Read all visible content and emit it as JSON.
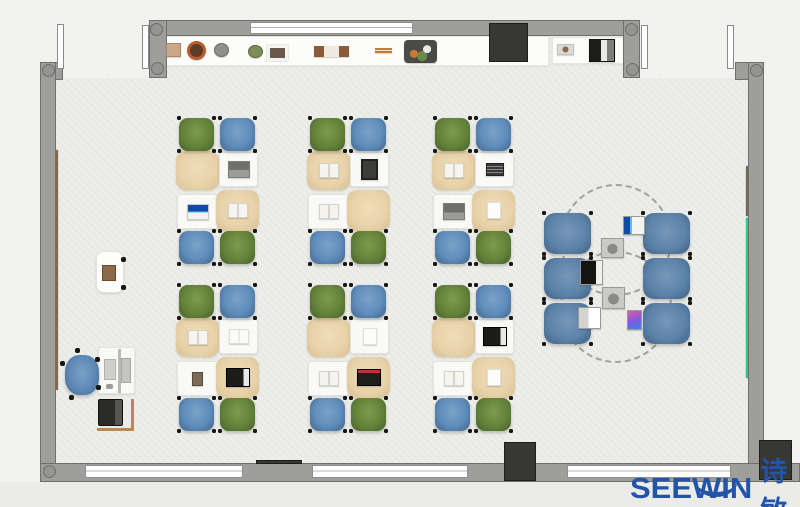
{
  "brand": {
    "name": "SEEWIN",
    "cjk": "诗敏",
    "color": "#2254a8"
  },
  "palette": {
    "wall": "#9e9e9c",
    "wall_edge": "#6f6f6d",
    "floor": "#e9e9e5",
    "outside": "#f2f2f0",
    "chair_green": "#64833a",
    "chair_blue": "#5f8cba",
    "chair_big_blue": "#5c82a8",
    "desk_cloth": "#e8d3ab",
    "desk_white": "#f9f9f7",
    "board_brown": "#8a6845",
    "board_olive": "#6f6a50",
    "board_green": "#2cc985",
    "dark_unit": "#373735"
  },
  "scene": {
    "floors": [
      {
        "name": "floor-main",
        "x": 56,
        "y": 78,
        "w": 692,
        "h": 385
      },
      {
        "name": "floor-top-strip",
        "x": 149,
        "y": 36,
        "w": 478,
        "h": 44
      },
      {
        "name": "outside-bottom",
        "x": 0,
        "y": 482,
        "w": 800,
        "h": 25,
        "c": "#ebebe8"
      }
    ],
    "boards": [
      {
        "name": "wall-board-brown",
        "x": 50,
        "y": 150,
        "w": 8,
        "h": 240,
        "c": "#8a6845"
      },
      {
        "name": "wall-board-olive",
        "x": 746,
        "y": 166,
        "w": 6,
        "h": 50,
        "c": "#6f6a50"
      },
      {
        "name": "wall-board-green",
        "x": 746,
        "y": 218,
        "w": 6,
        "h": 160,
        "c": "#2cc985"
      }
    ],
    "shelves": [
      {
        "name": "top-sideboard",
        "x": 163,
        "y": 36,
        "w": 386,
        "h": 30
      },
      {
        "name": "top-right-sideboard",
        "x": 552,
        "y": 37,
        "w": 75,
        "h": 27
      }
    ],
    "walls": [
      {
        "name": "wall-top",
        "x": 149,
        "y": 20,
        "w": 491,
        "h": 16
      },
      {
        "name": "wall-top-left-jamb",
        "x": 149,
        "y": 20,
        "w": 18,
        "h": 58
      },
      {
        "name": "wall-left-corner",
        "x": 40,
        "y": 62,
        "w": 23,
        "h": 18
      },
      {
        "name": "wall-left",
        "x": 40,
        "y": 62,
        "w": 16,
        "h": 420
      },
      {
        "name": "wall-top-right-jamb",
        "x": 623,
        "y": 20,
        "w": 17,
        "h": 58
      },
      {
        "name": "wall-right-corner",
        "x": 735,
        "y": 62,
        "w": 29,
        "h": 18
      },
      {
        "name": "wall-right",
        "x": 748,
        "y": 62,
        "w": 16,
        "h": 420
      },
      {
        "name": "wall-bottom",
        "x": 40,
        "y": 463,
        "w": 760,
        "h": 19
      }
    ],
    "windows": [
      {
        "name": "window-top",
        "x": 250,
        "y": 22,
        "w": 163,
        "h": 12
      },
      {
        "name": "window-bottom-left",
        "x": 85,
        "y": 465,
        "w": 158,
        "h": 13
      },
      {
        "name": "window-bottom-center",
        "x": 312,
        "y": 465,
        "w": 156,
        "h": 13
      },
      {
        "name": "window-bottom-right",
        "x": 567,
        "y": 465,
        "w": 164,
        "h": 13
      }
    ],
    "posts": [
      {
        "name": "wall-post",
        "x": 150,
        "y": 23
      },
      {
        "name": "wall-post",
        "x": 151,
        "y": 62
      },
      {
        "name": "wall-post",
        "x": 42,
        "y": 64
      },
      {
        "name": "wall-post",
        "x": 625,
        "y": 23
      },
      {
        "name": "wall-post",
        "x": 626,
        "y": 63
      },
      {
        "name": "wall-post",
        "x": 750,
        "y": 64
      },
      {
        "name": "wall-post",
        "x": 43,
        "y": 465
      }
    ],
    "doors": [
      {
        "name": "door-leaf-left-a",
        "x": 57,
        "y": 24,
        "w": 7,
        "h": 45
      },
      {
        "name": "door-leaf-left-b",
        "x": 142,
        "y": 25,
        "w": 7,
        "h": 44
      },
      {
        "name": "door-leaf-right-a",
        "x": 641,
        "y": 25,
        "w": 7,
        "h": 44
      },
      {
        "name": "door-leaf-right-b",
        "x": 727,
        "y": 25,
        "w": 7,
        "h": 44
      }
    ],
    "dark_boxes": [
      {
        "name": "column-cabinet-top",
        "x": 489,
        "y": 23,
        "w": 39,
        "h": 39
      },
      {
        "name": "ac-unit-bottom",
        "x": 504,
        "y": 442,
        "w": 32,
        "h": 39
      },
      {
        "name": "ac-unit-bottom-right",
        "x": 759,
        "y": 440,
        "w": 33,
        "h": 40
      },
      {
        "name": "sill-accent",
        "x": 256,
        "y": 460,
        "w": 46,
        "h": 4
      }
    ],
    "shelf_items": [
      {
        "name": "decor-box",
        "t": "box",
        "x": 166,
        "y": 43,
        "w": 15,
        "h": 14
      },
      {
        "name": "plant-pot-brown",
        "t": "potbrown",
        "x": 187,
        "y": 41,
        "w": 19,
        "h": 19
      },
      {
        "name": "plant-pot-gray",
        "t": "potgray",
        "x": 214,
        "y": 43,
        "w": 15,
        "h": 14
      },
      {
        "name": "plant-pot-green",
        "t": "potgreen",
        "x": 248,
        "y": 45,
        "w": 15,
        "h": 13
      },
      {
        "name": "photo-frame",
        "t": "frame",
        "x": 267,
        "y": 45,
        "w": 21,
        "h": 16
      },
      {
        "name": "book-stack",
        "t": "books",
        "x": 314,
        "y": 46,
        "w": 35,
        "h": 11
      },
      {
        "name": "decor-sticks",
        "t": "sticks",
        "x": 375,
        "y": 48,
        "w": 17,
        "h": 5
      },
      {
        "name": "plant-tray",
        "t": "tray",
        "x": 404,
        "y": 40,
        "w": 33,
        "h": 23
      },
      {
        "name": "small-tray",
        "t": "traysmall",
        "x": 557,
        "y": 44,
        "w": 17,
        "h": 11
      },
      {
        "name": "printer",
        "t": "printer",
        "x": 589,
        "y": 39,
        "w": 26,
        "h": 23
      }
    ],
    "clusters": [
      {
        "name": "desk-cluster-r1c1",
        "x": 176,
        "y": 118,
        "chairs": [
          "green",
          "blue",
          "blue",
          "green"
        ],
        "items": {
          "tl": null,
          "tr": "laptop-gray",
          "bl": "laptop-blue",
          "br": "book-open"
        }
      },
      {
        "name": "desk-cluster-r1c2",
        "x": 307,
        "y": 118,
        "chairs": [
          "green",
          "blue",
          "blue",
          "green"
        ],
        "items": {
          "tl": "book-open",
          "tr": "tablet-dark",
          "bl": "book-open",
          "br": null
        }
      },
      {
        "name": "desk-cluster-r1c3",
        "x": 432,
        "y": 118,
        "chairs": [
          "green",
          "blue",
          "blue",
          "green"
        ],
        "items": {
          "tl": "book-open",
          "tr": "book-dark",
          "bl": "laptop-gray",
          "br": "paper"
        }
      },
      {
        "name": "desk-cluster-r2c1",
        "x": 176,
        "y": 285,
        "chairs": [
          "green",
          "blue",
          "blue",
          "green"
        ],
        "items": {
          "tl": "book-open",
          "tr": "book-white",
          "bl": "photo",
          "br": "laptop-black"
        }
      },
      {
        "name": "desk-cluster-r2c2",
        "x": 307,
        "y": 285,
        "chairs": [
          "green",
          "blue",
          "blue",
          "green"
        ],
        "items": {
          "tl": null,
          "tr": "paper",
          "bl": "book-open",
          "br": "laptop-red"
        }
      },
      {
        "name": "desk-cluster-r2c3",
        "x": 432,
        "y": 285,
        "chairs": [
          "green",
          "blue",
          "blue",
          "green"
        ],
        "items": {
          "tl": null,
          "tr": "laptop-black",
          "bl": "book-open",
          "br": "paper"
        }
      }
    ],
    "discussion": {
      "circles": [
        {
          "name": "discussion-circle-top",
          "x": 560,
          "y": 184,
          "w": 112,
          "h": 112
        },
        {
          "name": "discussion-circle-bottom",
          "x": 560,
          "y": 251,
          "w": 112,
          "h": 112
        }
      ],
      "chairs": [
        {
          "x": 544,
          "y": 213
        },
        {
          "x": 544,
          "y": 258
        },
        {
          "x": 544,
          "y": 303
        },
        {
          "x": 643,
          "y": 213
        },
        {
          "x": 643,
          "y": 258
        },
        {
          "x": 643,
          "y": 303
        }
      ],
      "chair_w": 47,
      "chair_h": 41,
      "devices": [
        {
          "name": "laptop-blue-screen",
          "t": "laptop-blue-side",
          "x": 623,
          "y": 216,
          "w": 22,
          "h": 19
        },
        {
          "name": "tablet-sketch",
          "t": "tablet-gray",
          "x": 601,
          "y": 238,
          "w": 23,
          "h": 20
        },
        {
          "name": "laptop-black",
          "t": "laptop-black",
          "x": 580,
          "y": 260,
          "w": 23,
          "h": 25
        },
        {
          "name": "tablet-sketch",
          "t": "tablet-gray",
          "x": 602,
          "y": 287,
          "w": 23,
          "h": 22
        },
        {
          "name": "laptop-white",
          "t": "laptop-white",
          "x": 578,
          "y": 307,
          "w": 23,
          "h": 22
        },
        {
          "name": "tablet-color",
          "t": "tablet-color",
          "x": 627,
          "y": 310,
          "w": 15,
          "h": 20
        }
      ]
    },
    "teacher": {
      "podium": {
        "name": "podium",
        "x": 96,
        "y": 251,
        "w": 28,
        "h": 42
      },
      "chair": {
        "name": "teacher-office-chair",
        "x": 65,
        "y": 355,
        "w": 34,
        "h": 40
      },
      "desk": {
        "name": "teacher-desk",
        "x": 98,
        "y": 347,
        "w": 37,
        "h": 47
      },
      "monitor_bar": {
        "x": 118,
        "y": 349,
        "w": 3,
        "h": 44
      },
      "monitor": {
        "x": 121,
        "y": 358,
        "w": 10,
        "h": 25
      },
      "keyboard": {
        "x": 104,
        "y": 359,
        "w": 12,
        "h": 21
      },
      "mouse": {
        "x": 106,
        "y": 384,
        "w": 7,
        "h": 5
      },
      "printer": {
        "name": "teacher-printer",
        "x": 98,
        "y": 399,
        "w": 25,
        "h": 27
      },
      "table_h": {
        "x": 97,
        "y": 428,
        "w": 37,
        "h": 3
      },
      "table_v": {
        "x": 131,
        "y": 399,
        "w": 3,
        "h": 31
      }
    },
    "logo_pos": {
      "x": 630,
      "y": 450
    }
  }
}
